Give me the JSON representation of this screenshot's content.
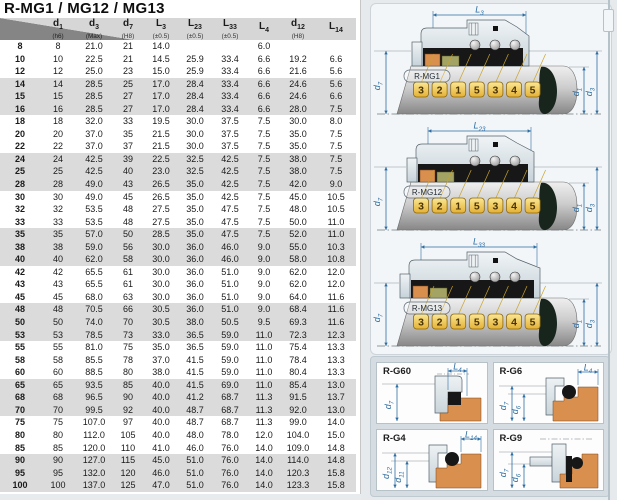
{
  "page": {
    "title": "R-MG1 / MG12 / MG13"
  },
  "table": {
    "columns": [
      {
        "sym": "",
        "sub": "",
        "note": ""
      },
      {
        "sym": "d",
        "sub": "1",
        "note": "(h6)"
      },
      {
        "sym": "d",
        "sub": "3",
        "note": "(Max)"
      },
      {
        "sym": "d",
        "sub": "7",
        "note": "(H8)"
      },
      {
        "sym": "L",
        "sub": "3",
        "note": "(±0.5)"
      },
      {
        "sym": "L",
        "sub": "23",
        "note": "(±0.5)"
      },
      {
        "sym": "L",
        "sub": "33",
        "note": "(±0.5)"
      },
      {
        "sym": "L",
        "sub": "4",
        "note": ""
      },
      {
        "sym": "d",
        "sub": "12",
        "note": "(H8)"
      },
      {
        "sym": "L",
        "sub": "14",
        "note": ""
      }
    ],
    "rows": [
      [
        "8",
        "8",
        "21.0",
        "21",
        "14.0",
        "",
        "",
        "6.0",
        "",
        ""
      ],
      [
        "10",
        "10",
        "22.5",
        "21",
        "14.5",
        "25.9",
        "33.4",
        "6.6",
        "19.2",
        "6.6"
      ],
      [
        "12",
        "12",
        "25.0",
        "23",
        "15.0",
        "25.9",
        "33.4",
        "6.6",
        "21.6",
        "5.6"
      ],
      [
        "14",
        "14",
        "28.5",
        "25",
        "17.0",
        "28.4",
        "33.4",
        "6.6",
        "24.6",
        "5.6"
      ],
      [
        "15",
        "15",
        "28.5",
        "27",
        "17.0",
        "28.4",
        "33.4",
        "6.6",
        "24.6",
        "6.6"
      ],
      [
        "16",
        "16",
        "28.5",
        "27",
        "17.0",
        "28.4",
        "33.4",
        "6.6",
        "28.0",
        "7.5"
      ],
      [
        "18",
        "18",
        "32.0",
        "33",
        "19.5",
        "30.0",
        "37.5",
        "7.5",
        "30.0",
        "8.0"
      ],
      [
        "20",
        "20",
        "37.0",
        "35",
        "21.5",
        "30.0",
        "37.5",
        "7.5",
        "35.0",
        "7.5"
      ],
      [
        "22",
        "22",
        "37.0",
        "37",
        "21.5",
        "30.0",
        "37.5",
        "7.5",
        "35.0",
        "7.5"
      ],
      [
        "24",
        "24",
        "42.5",
        "39",
        "22.5",
        "32.5",
        "42.5",
        "7.5",
        "38.0",
        "7.5"
      ],
      [
        "25",
        "25",
        "42.5",
        "40",
        "23.0",
        "32.5",
        "42.5",
        "7.5",
        "38.0",
        "7.5"
      ],
      [
        "28",
        "28",
        "49.0",
        "43",
        "26.5",
        "35.0",
        "42.5",
        "7.5",
        "42.0",
        "9.0"
      ],
      [
        "30",
        "30",
        "49.0",
        "45",
        "26.5",
        "35.0",
        "42.5",
        "7.5",
        "45.0",
        "10.5"
      ],
      [
        "32",
        "32",
        "53.5",
        "48",
        "27.5",
        "35.0",
        "47.5",
        "7.5",
        "48.0",
        "10.5"
      ],
      [
        "33",
        "33",
        "53.5",
        "48",
        "27.5",
        "35.0",
        "47.5",
        "7.5",
        "50.0",
        "11.0"
      ],
      [
        "35",
        "35",
        "57.0",
        "50",
        "28.5",
        "35.0",
        "47.5",
        "7.5",
        "52.0",
        "11.0"
      ],
      [
        "38",
        "38",
        "59.0",
        "56",
        "30.0",
        "36.0",
        "46.0",
        "9.0",
        "55.0",
        "10.3"
      ],
      [
        "40",
        "40",
        "62.0",
        "58",
        "30.0",
        "36.0",
        "46.0",
        "9.0",
        "58.0",
        "10.8"
      ],
      [
        "42",
        "42",
        "65.5",
        "61",
        "30.0",
        "36.0",
        "51.0",
        "9.0",
        "62.0",
        "12.0"
      ],
      [
        "43",
        "43",
        "65.5",
        "61",
        "30.0",
        "36.0",
        "51.0",
        "9.0",
        "62.0",
        "12.0"
      ],
      [
        "45",
        "45",
        "68.0",
        "63",
        "30.0",
        "36.0",
        "51.0",
        "9.0",
        "64.0",
        "11.6"
      ],
      [
        "48",
        "48",
        "70.5",
        "66",
        "30.5",
        "36.0",
        "51.0",
        "9.0",
        "68.4",
        "11.6"
      ],
      [
        "50",
        "50",
        "74.0",
        "70",
        "30.5",
        "38.0",
        "50.5",
        "9.5",
        "69.3",
        "11.6"
      ],
      [
        "53",
        "53",
        "78.5",
        "73",
        "33.0",
        "36.5",
        "59.0",
        "11.0",
        "72.3",
        "12.3"
      ],
      [
        "55",
        "55",
        "81.0",
        "75",
        "35.0",
        "36.5",
        "59.0",
        "11.0",
        "75.4",
        "13.3"
      ],
      [
        "58",
        "58",
        "85.5",
        "78",
        "37.0",
        "41.5",
        "59.0",
        "11.0",
        "78.4",
        "13.3"
      ],
      [
        "60",
        "60",
        "88.5",
        "80",
        "38.0",
        "41.5",
        "59.0",
        "11.0",
        "80.4",
        "13.3"
      ],
      [
        "65",
        "65",
        "93.5",
        "85",
        "40.0",
        "41.5",
        "69.0",
        "11.0",
        "85.4",
        "13.0"
      ],
      [
        "68",
        "68",
        "96.5",
        "90",
        "40.0",
        "41.2",
        "68.7",
        "11.3",
        "91.5",
        "13.7"
      ],
      [
        "70",
        "70",
        "99.5",
        "92",
        "40.0",
        "48.7",
        "68.7",
        "11.3",
        "92.0",
        "13.0"
      ],
      [
        "75",
        "75",
        "107.0",
        "97",
        "40.0",
        "48.7",
        "68.7",
        "11.3",
        "99.0",
        "14.0"
      ],
      [
        "80",
        "80",
        "112.0",
        "105",
        "40.0",
        "48.0",
        "78.0",
        "12.0",
        "104.0",
        "15.0"
      ],
      [
        "85",
        "85",
        "120.0",
        "110",
        "41.0",
        "46.0",
        "76.0",
        "14.0",
        "109.0",
        "14.8"
      ],
      [
        "90",
        "90",
        "127.0",
        "115",
        "45.0",
        "51.0",
        "76.0",
        "14.0",
        "114.0",
        "14.8"
      ],
      [
        "95",
        "95",
        "132.0",
        "120",
        "46.0",
        "51.0",
        "76.0",
        "14.0",
        "120.3",
        "15.8"
      ],
      [
        "100",
        "100",
        "137.0",
        "125",
        "47.0",
        "51.0",
        "76.0",
        "14.0",
        "123.3",
        "15.8"
      ]
    ]
  },
  "main_diagrams": [
    {
      "label": "R-MG1",
      "top_dim": {
        "sym": "L",
        "sub": "3"
      },
      "left_dim": {
        "sym": "d",
        "sub": "7"
      },
      "right_dims": [
        {
          "sym": "d",
          "sub": "1"
        },
        {
          "sym": "d",
          "sub": "3"
        }
      ],
      "tags": [
        "3",
        "2",
        "1",
        "5",
        "3",
        "4",
        "5"
      ]
    },
    {
      "label": "R-MG12",
      "top_dim": {
        "sym": "L",
        "sub": "23"
      },
      "left_dim": {
        "sym": "d",
        "sub": "7"
      },
      "right_dims": [
        {
          "sym": "d",
          "sub": "1"
        },
        {
          "sym": "d",
          "sub": "3"
        }
      ],
      "tags": [
        "3",
        "2",
        "1",
        "5",
        "3",
        "4",
        "5"
      ]
    },
    {
      "label": "R-MG13",
      "top_dim": {
        "sym": "L",
        "sub": "33"
      },
      "left_dim": {
        "sym": "d",
        "sub": "7"
      },
      "right_dims": [
        {
          "sym": "d",
          "sub": "1"
        },
        {
          "sym": "d",
          "sub": "3"
        }
      ],
      "tags": [
        "3",
        "2",
        "1",
        "5",
        "3",
        "4",
        "5"
      ]
    }
  ],
  "detail_diagrams": [
    {
      "label": "R-G60",
      "variant": "g60",
      "top_dim": {
        "sym": "L",
        "sub": "4"
      },
      "left_dims": [
        {
          "sym": "d",
          "sub": "7"
        }
      ]
    },
    {
      "label": "R-G6",
      "variant": "g6",
      "top_dim": {
        "sym": "L",
        "sub": "4"
      },
      "left_dims": [
        {
          "sym": "d",
          "sub": "7"
        },
        {
          "sym": "d",
          "sub": "6"
        }
      ]
    },
    {
      "label": "R-G4",
      "variant": "g6",
      "top_dim": {
        "sym": "L",
        "sub": "14"
      },
      "left_dims": [
        {
          "sym": "d",
          "sub": "12"
        },
        {
          "sym": "d",
          "sub": "11"
        }
      ]
    },
    {
      "label": "R-G9",
      "variant": "g9",
      "top_dim": null,
      "left_dims": [
        {
          "sym": "d",
          "sub": "7"
        },
        {
          "sym": "d",
          "sub": "6"
        }
      ]
    }
  ],
  "colors": {
    "accent_blue": "#2d6da3",
    "tag_gold": "#eec44a",
    "tag_border": "#8a6914",
    "tag_text": "#4a3303",
    "seat_orange": "#d9904f",
    "ring_olive": "#a3a464",
    "rubber_black": "#171717",
    "band_gray": "#dbdbdb",
    "header_gray": "#d6d6d6",
    "drop_dark": "#17251d"
  }
}
